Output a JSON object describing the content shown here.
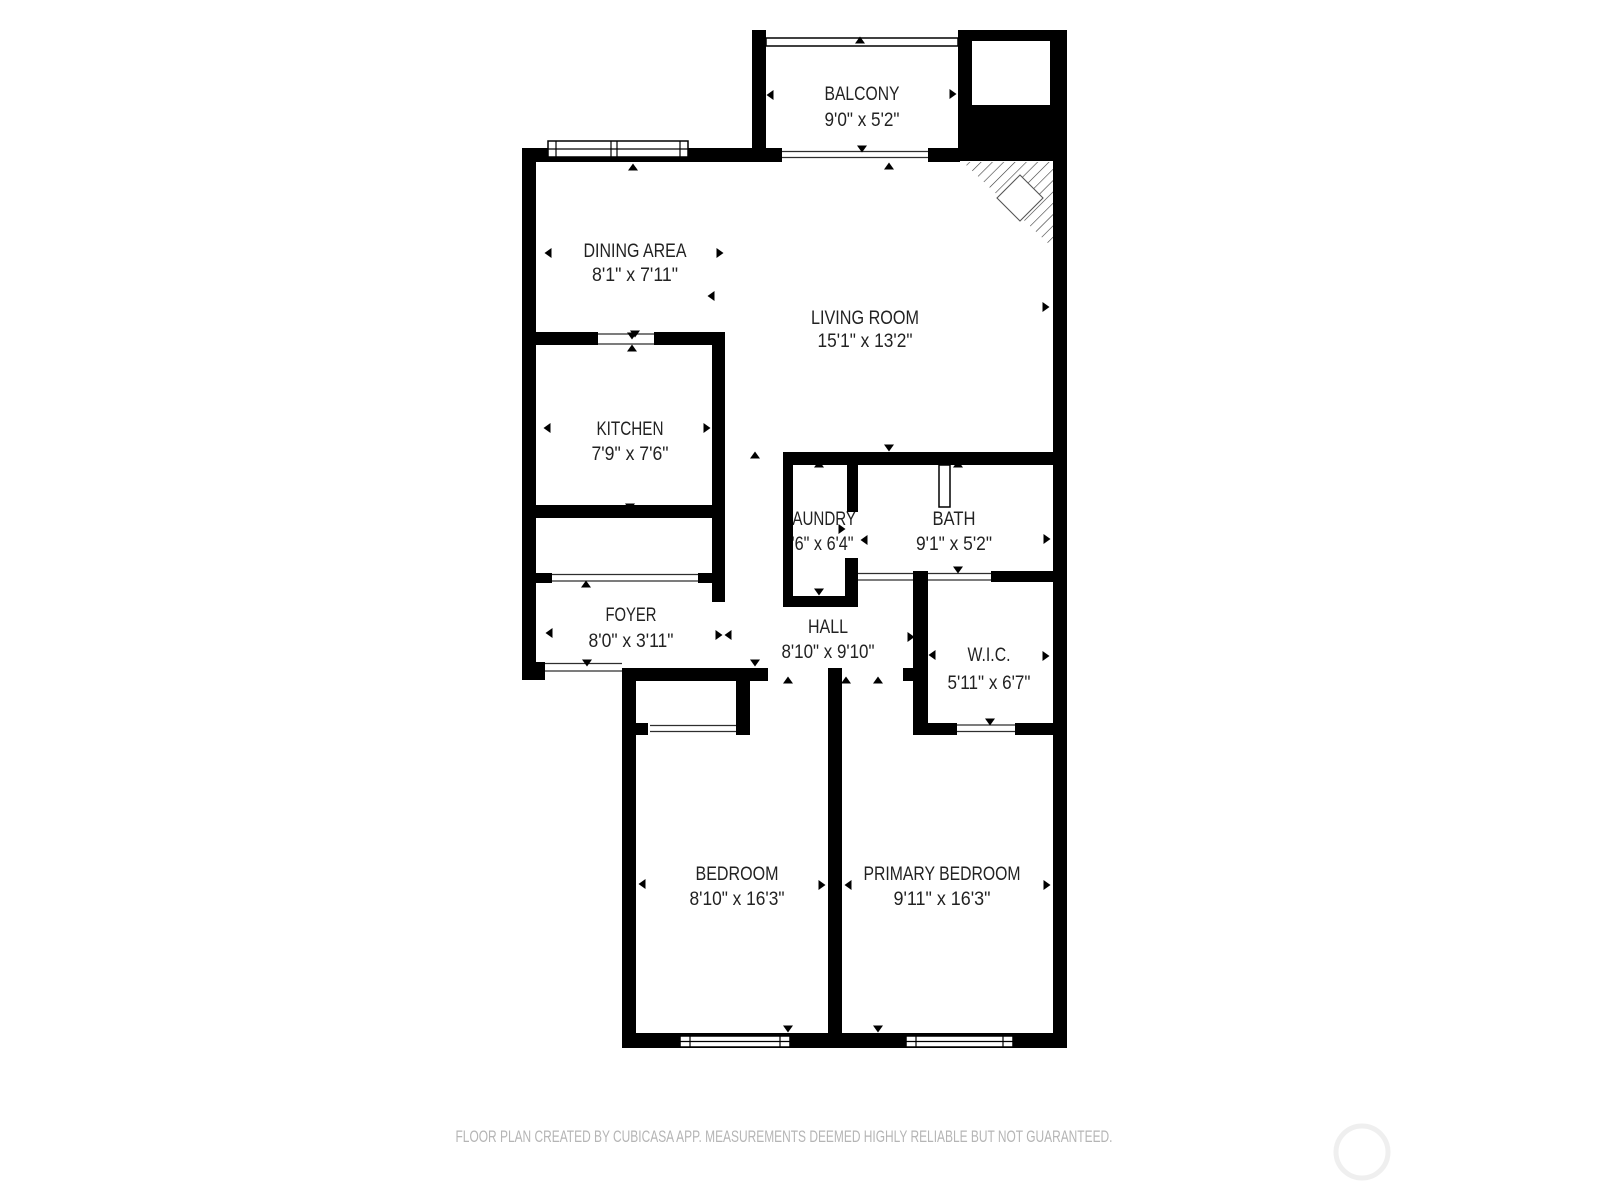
{
  "plan": {
    "rooms": [
      {
        "name": "BALCONY",
        "dims": "9'0\" x 5'2\""
      },
      {
        "name": "DINING AREA",
        "dims": "8'1\" x 7'11\""
      },
      {
        "name": "LIVING ROOM",
        "dims": "15'1\" x 13'2\""
      },
      {
        "name": "KITCHEN",
        "dims": "7'9\" x 7'6\""
      },
      {
        "name": "LAUNDRY",
        "dims": "2'6\" x 6'4\""
      },
      {
        "name": "BATH",
        "dims": "9'1\" x 5'2\""
      },
      {
        "name": "FOYER",
        "dims": "8'0\" x 3'11\""
      },
      {
        "name": "HALL",
        "dims": "8'10\" x 9'10\""
      },
      {
        "name": "W.I.C.",
        "dims": "5'11\" x 6'7\""
      },
      {
        "name": "BEDROOM",
        "dims": "8'10\" x 16'3\""
      },
      {
        "name": "PRIMARY BEDROOM",
        "dims": "9'11\" x 16'3\""
      }
    ]
  },
  "footer": {
    "disclaimer": "FLOOR PLAN CREATED BY CUBICASA APP. MEASUREMENTS DEEMED HIGHLY RELIABLE BUT NOT GUARANTEED."
  },
  "colors": {
    "wall": "#000000",
    "room_text": "#222222",
    "footer_text": "#b5b5b5",
    "watermark_ring": "#efefef",
    "background": "#ffffff"
  }
}
